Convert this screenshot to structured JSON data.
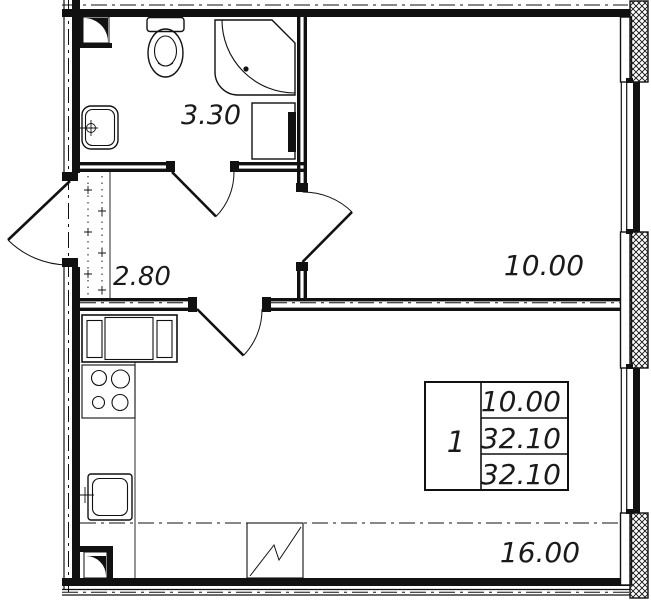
{
  "plan": {
    "rooms": {
      "bathroom": {
        "area_label": "3.30"
      },
      "hallway": {
        "area_label": "2.80"
      },
      "room": {
        "area_label": "10.00"
      },
      "kitchen_living": {
        "area_label": "16.00"
      }
    },
    "stamp": {
      "rooms_count": "1",
      "rows": [
        "10.00",
        "32.10",
        "32.10"
      ]
    },
    "colors": {
      "line": "#111111",
      "background": "#ffffff"
    }
  }
}
